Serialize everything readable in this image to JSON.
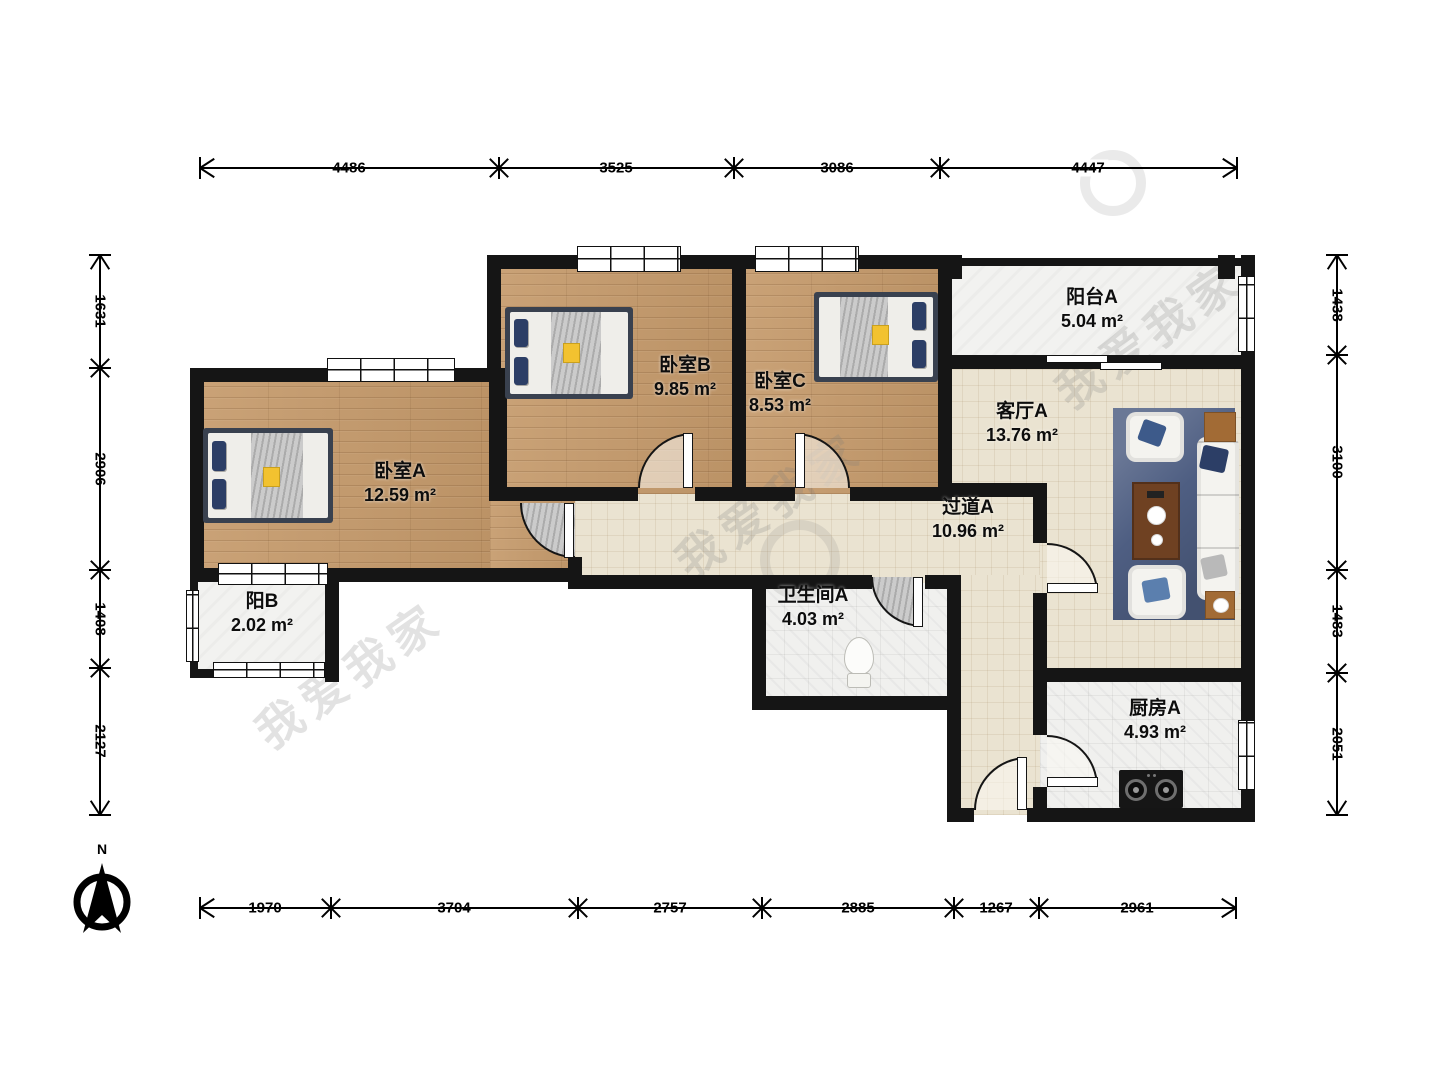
{
  "rooms": {
    "bedroom_a": {
      "name": "卧室A",
      "area": "12.59 m²"
    },
    "bedroom_b": {
      "name": "卧室B",
      "area": "9.85 m²"
    },
    "bedroom_c": {
      "name": "卧室C",
      "area": "8.53 m²"
    },
    "balcony_a": {
      "name": "阳台A",
      "area": "5.04 m²"
    },
    "living_a": {
      "name": "客厅A",
      "area": "13.76 m²"
    },
    "hallway_a": {
      "name": "过道A",
      "area": "10.96 m²"
    },
    "bath_a": {
      "name": "卫生间A",
      "area": "4.03 m²"
    },
    "balcony_b": {
      "name": "阳B",
      "area": "2.02 m²"
    },
    "kitchen_a": {
      "name": "厨房A",
      "area": "4.93 m²"
    }
  },
  "dimensions": {
    "top": [
      "4486",
      "3525",
      "3086",
      "4447"
    ],
    "bottom": [
      "1970",
      "3704",
      "2757",
      "2885",
      "1267",
      "2961"
    ],
    "left": [
      "1631",
      "2906",
      "1408",
      "2127"
    ],
    "right": [
      "1438",
      "3100",
      "1483",
      "2051"
    ]
  },
  "compass": {
    "label": "N"
  },
  "watermark": {
    "text": "我爱我家"
  },
  "colors": {
    "wall": "#151515",
    "wood_floor": "#c59a6b",
    "beige_floor": "#eae3d1",
    "tile_floor": "#f0f0ee",
    "rug": "#4e5e82",
    "pillow_navy": "#2c3e66",
    "accent_yellow": "#f2c230"
  }
}
